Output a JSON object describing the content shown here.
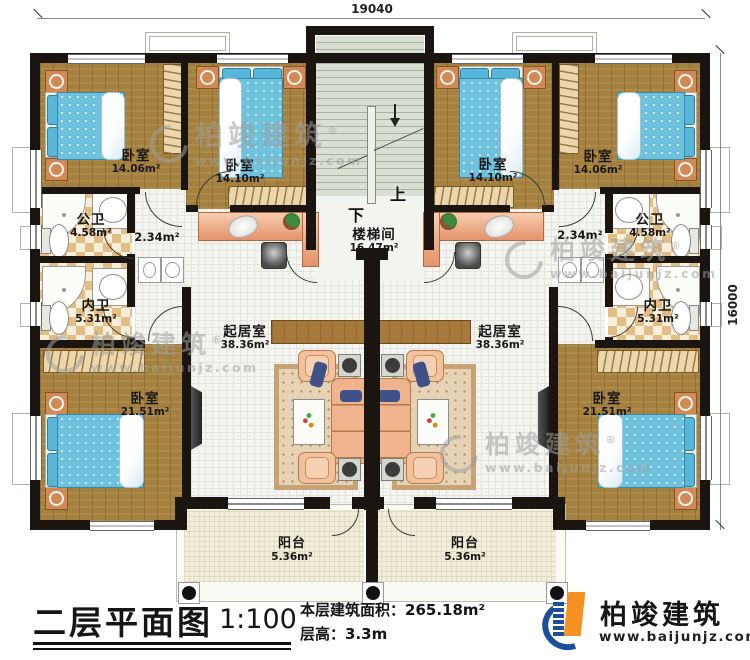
{
  "colors": {
    "wall": "#1a1510",
    "wood_floor": "#a5813f",
    "bath_checker": "#e2bd85",
    "tile_floor": "#f4f4f1",
    "stair_floor": "#d9ded3",
    "balcony_floor": "#f1eed9",
    "bed_blue": "#6fc2de",
    "sofa_peach": "#efb48d",
    "logo_blue": "#1d4e9e",
    "logo_orange": "#f59120",
    "watermark_gray": "#9f9f9f"
  },
  "dimensions": {
    "top_width": "19040",
    "right_height": "16000"
  },
  "stairwell": {
    "name": "楼梯间",
    "area": "16.47m²",
    "up_label": "上",
    "down_label": "下"
  },
  "rooms": {
    "bedroom_top_left": {
      "name": "卧室",
      "area": "14.06m²"
    },
    "bedroom_top_left2": {
      "name": "卧室",
      "area": "14.10m²"
    },
    "bedroom_top_right2": {
      "name": "卧室",
      "area": "14.10m²"
    },
    "bedroom_top_right": {
      "name": "卧室",
      "area": "14.06m²"
    },
    "public_bath_left": {
      "name": "公卫",
      "area": "4.58m²"
    },
    "public_bath_right": {
      "name": "公卫",
      "area": "4.58m²"
    },
    "inner_bath_left": {
      "name": "内卫",
      "area": "5.31m²"
    },
    "inner_bath_right": {
      "name": "内卫",
      "area": "5.31m²"
    },
    "hall_left": {
      "area": "2.34m²"
    },
    "hall_right": {
      "area": "2.34m²"
    },
    "living_left": {
      "name": "起居室",
      "area": "38.36m²"
    },
    "living_right": {
      "name": "起居室",
      "area": "38.36m²"
    },
    "bedroom_bottom_left": {
      "name": "卧室",
      "area": "21.51m²"
    },
    "bedroom_bottom_right": {
      "name": "卧室",
      "area": "21.51m²"
    },
    "balcony_left": {
      "name": "阳台",
      "area": "5.36m²"
    },
    "balcony_right": {
      "name": "阳台",
      "area": "5.36m²"
    }
  },
  "watermark": {
    "brand": "柏竣建筑",
    "reg": "®",
    "url": "www.baijunjz.com"
  },
  "title_block": {
    "title": "二层平面图",
    "scale": "1:100",
    "area_label": "本层建筑面积：",
    "area_value": "265.18m²",
    "floor_height_label": "层高：",
    "floor_height_value": "3.3m"
  },
  "logo": {
    "brand": "柏竣建筑",
    "url": "www.baijunjz.com"
  }
}
